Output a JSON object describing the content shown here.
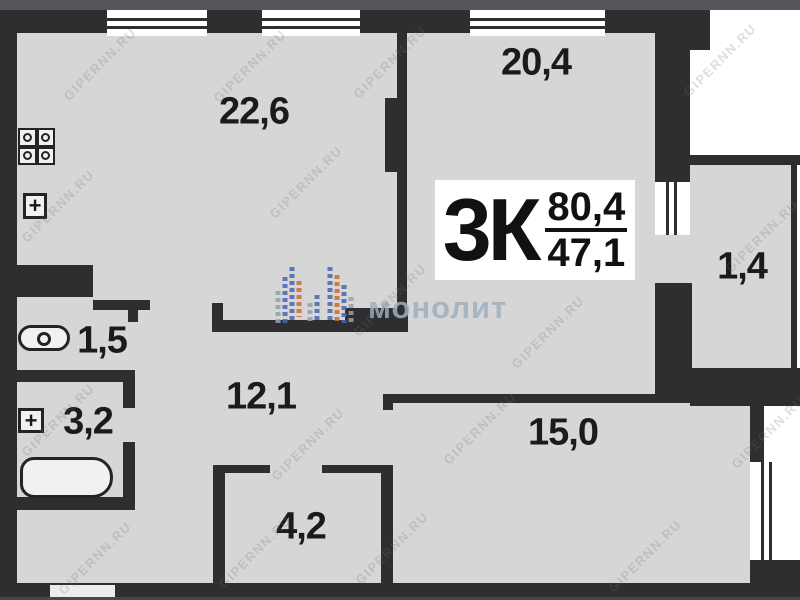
{
  "plan_title": {
    "apartment_type": "3К",
    "total_area": "80,4",
    "living_area": "47,1"
  },
  "rooms": {
    "kitchen_living": "22,6",
    "bedroom_top": "20,4",
    "balcony": "1,4",
    "wc": "1,5",
    "bathroom": "3,2",
    "hallway": "12,1",
    "bedroom_bottom": "15,0",
    "storage": "4,2"
  },
  "fixtures": {
    "plus_symbol": "+"
  },
  "watermarks": {
    "brand": "монолит",
    "site": "GIPERNN.RU"
  },
  "colors": {
    "wall": "#2e2e30",
    "room_fill": "#d6d6d6",
    "edge_strip": "#56565a",
    "brand_watermark": "#9db0c2",
    "logo_blue": "#4a66b0",
    "logo_orange": "#cf6a31",
    "logo_gray": "#97a1ad"
  }
}
